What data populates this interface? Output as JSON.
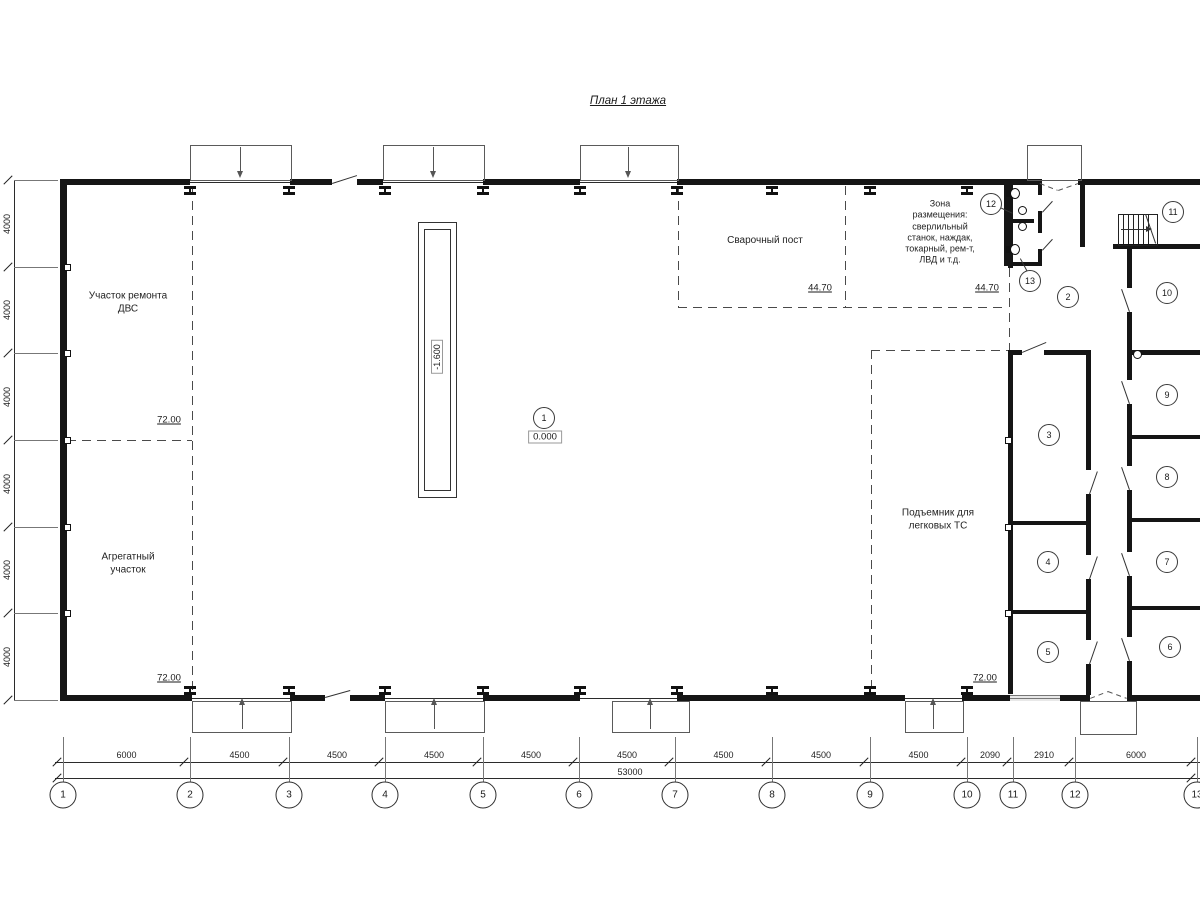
{
  "title": "План 1 этажа",
  "zones": {
    "engine_repair": "Участок ремонта\nДВС",
    "aggregate": "Агрегатный\nучасток",
    "welding": "Сварочный пост",
    "equipment": "Зона\nразмещения:\nсверлильный\nстанок, наждак,\nтокарный, рем-т,\nЛВД и т.д.",
    "car_lift": "Подъемник для\nлегковых ТС"
  },
  "elevations": {
    "pit_depth": "-1.600",
    "floor_level": "0.000",
    "welding_area_left": "44.70",
    "welding_area_right": "44.70",
    "engine_area": "72.00",
    "aggregate_area": "72.00",
    "lift_area": "72.00"
  },
  "room_tags": [
    "1",
    "2",
    "3",
    "4",
    "5",
    "6",
    "7",
    "8",
    "9",
    "10",
    "11",
    "12",
    "13"
  ],
  "grid_axes": {
    "labels": [
      "1",
      "2",
      "3",
      "4",
      "5",
      "6",
      "7",
      "8",
      "9",
      "10",
      "11",
      "12",
      "13"
    ]
  },
  "dimensions": {
    "bottom_segments": [
      "6000",
      "4500",
      "4500",
      "4500",
      "4500",
      "4500",
      "4500",
      "4500",
      "4500",
      "2090",
      "2910",
      "6000"
    ],
    "bottom_total": "53000",
    "left_segments": [
      "4000",
      "4000",
      "4000",
      "4000",
      "4000",
      "4000"
    ]
  }
}
